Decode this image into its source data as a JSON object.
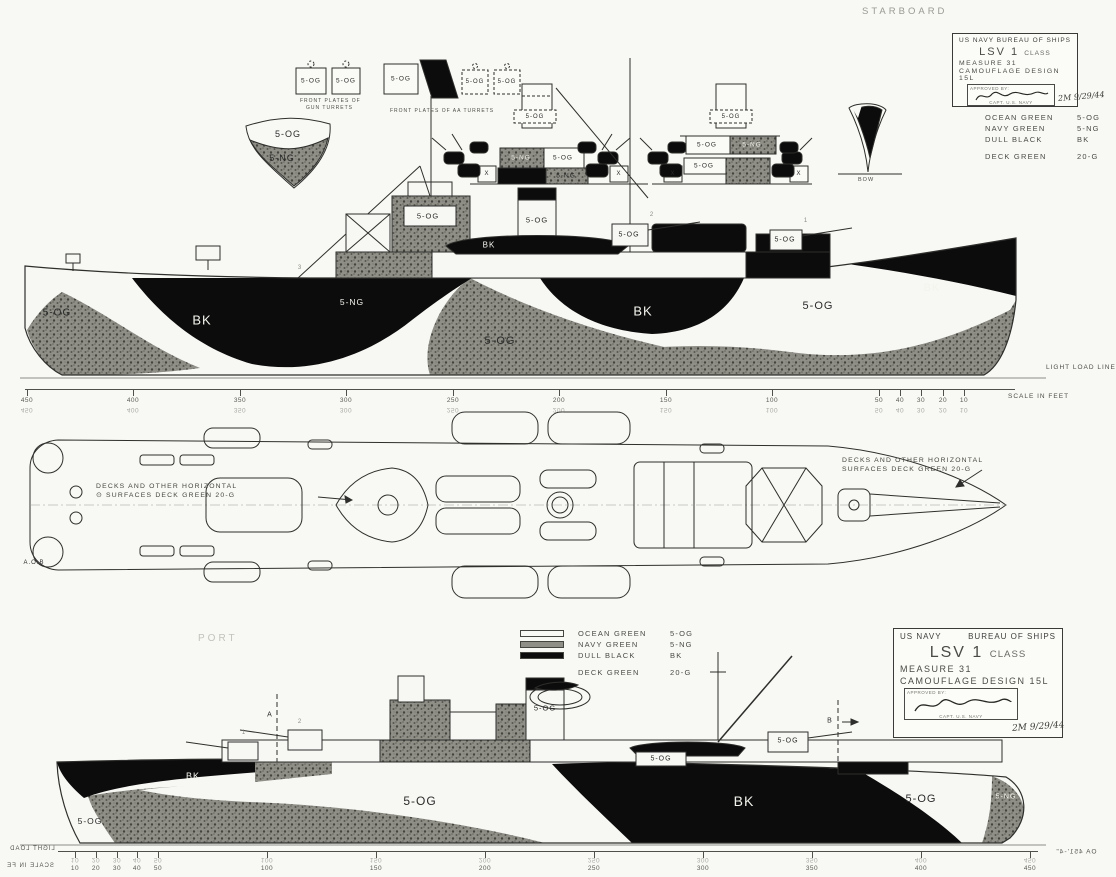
{
  "page": {
    "starboard_label": "STARBOARD",
    "port_label": "PORT",
    "light_load_line": "LIGHT LOAD LINE",
    "aob_label": "A.O.B"
  },
  "title_block": {
    "agency": "US NAVY",
    "bureau": "BUREAU OF SHIPS",
    "ship_class": "LSV 1",
    "class_suffix": "CLASS",
    "measure": "MEASURE 31",
    "design": "CAMOUFLAGE DESIGN 15L",
    "approved_label": "APPROVED BY:",
    "signer_title": "CAPT. U.S. NAVY",
    "date_note": "2M 9/29/44"
  },
  "legend": {
    "rows": [
      {
        "name": "OCEAN GREEN",
        "code": "5-OG"
      },
      {
        "name": "NAVY GREEN",
        "code": "5-NG"
      },
      {
        "name": "DULL BLACK",
        "code": "BK"
      },
      {
        "name": "DECK GREEN",
        "code": "20-G"
      }
    ]
  },
  "deck_note": {
    "symbol": "⊙",
    "line1": "DECKS AND OTHER HORIZONTAL",
    "line2": "SURFACES   DECK GREEN   20-G"
  },
  "details": {
    "gun_caption_1": "FRONT PLATES OF",
    "gun_caption_2": "GUN TURRETS",
    "aa_caption": "FRONT PLATES OF AA TURRETS",
    "bow_caption": "BOW"
  },
  "scales": {
    "label": "SCALE IN FEET",
    "top": {
      "ticks": [
        {
          "v": "450",
          "x": 2
        },
        {
          "v": "400",
          "x": 108
        },
        {
          "v": "350",
          "x": 215
        },
        {
          "v": "300",
          "x": 321
        },
        {
          "v": "250",
          "x": 428
        },
        {
          "v": "200",
          "x": 534
        },
        {
          "v": "150",
          "x": 641
        },
        {
          "v": "100",
          "x": 747
        },
        {
          "v": "50",
          "x": 854
        },
        {
          "v": "40",
          "x": 875
        },
        {
          "v": "30",
          "x": 896
        },
        {
          "v": "20",
          "x": 918
        },
        {
          "v": "10",
          "x": 939
        }
      ]
    },
    "bottom": {
      "ticks": [
        {
          "v": "10",
          "x": 17
        },
        {
          "v": "20",
          "x": 38
        },
        {
          "v": "30",
          "x": 59
        },
        {
          "v": "40",
          "x": 79
        },
        {
          "v": "50",
          "x": 100
        },
        {
          "v": "100",
          "x": 209
        },
        {
          "v": "150",
          "x": 318
        },
        {
          "v": "200",
          "x": 427
        },
        {
          "v": "250",
          "x": 536
        },
        {
          "v": "300",
          "x": 645
        },
        {
          "v": "350",
          "x": 754
        },
        {
          "v": "400",
          "x": 863
        },
        {
          "v": "450",
          "x": 972
        }
      ]
    }
  },
  "labels": {
    "detail_strip": [
      {
        "t": "5-OG",
        "x": 288,
        "y": 134,
        "s": 9
      },
      {
        "t": "5-NG",
        "x": 282,
        "y": 158,
        "s": 9
      },
      {
        "t": "5-OG",
        "x": 311,
        "y": 81,
        "s": 6.5
      },
      {
        "t": "5-OG",
        "x": 346,
        "y": 81,
        "s": 6.5
      },
      {
        "t": "5-OG",
        "x": 401,
        "y": 79,
        "s": 6.5
      },
      {
        "t": "5-OG",
        "x": 475,
        "y": 82,
        "s": 6
      },
      {
        "t": "5-OG",
        "x": 507,
        "y": 82,
        "s": 6
      },
      {
        "t": "5-OG",
        "x": 535,
        "y": 117,
        "s": 6
      },
      {
        "t": "5-NG",
        "x": 521,
        "y": 158,
        "s": 6.5,
        "c": "white"
      },
      {
        "t": "5-OG",
        "x": 563,
        "y": 158,
        "s": 6.5
      },
      {
        "t": "5-NG",
        "x": 566,
        "y": 176,
        "s": 6.5
      },
      {
        "t": "5-OG",
        "x": 731,
        "y": 117,
        "s": 6
      },
      {
        "t": "5-OG",
        "x": 707,
        "y": 145,
        "s": 6.5
      },
      {
        "t": "5-NG",
        "x": 752,
        "y": 145,
        "s": 6.5,
        "c": "white"
      },
      {
        "t": "5-OG",
        "x": 704,
        "y": 166,
        "s": 6.5
      },
      {
        "t": "X",
        "x": 487,
        "y": 174,
        "s": 6
      },
      {
        "t": "X",
        "x": 619,
        "y": 174,
        "s": 6
      },
      {
        "t": "X",
        "x": 673,
        "y": 174,
        "s": 6
      },
      {
        "t": "X",
        "x": 799,
        "y": 174,
        "s": 6
      }
    ],
    "starboard": [
      {
        "t": "5-OG",
        "x": 57,
        "y": 313,
        "s": 10
      },
      {
        "t": "BK",
        "x": 202,
        "y": 320,
        "s": 13,
        "c": "white"
      },
      {
        "t": "5-OG",
        "x": 500,
        "y": 341,
        "s": 11
      },
      {
        "t": "BK",
        "x": 643,
        "y": 311,
        "s": 13,
        "c": "white"
      },
      {
        "t": "5-OG",
        "x": 818,
        "y": 306,
        "s": 11
      },
      {
        "t": "BK",
        "x": 932,
        "y": 288,
        "s": 11,
        "c": "white"
      },
      {
        "t": "5-NG",
        "x": 794,
        "y": 357,
        "s": 8.5,
        "c": "faint"
      },
      {
        "t": "5-NG",
        "x": 352,
        "y": 302,
        "s": 8.5,
        "c": "white"
      },
      {
        "t": "5-OG",
        "x": 428,
        "y": 216,
        "s": 7.5
      },
      {
        "t": "5-OG",
        "x": 537,
        "y": 220,
        "s": 7.5
      },
      {
        "t": "BK",
        "x": 489,
        "y": 245,
        "s": 8,
        "c": "white"
      },
      {
        "t": "5-OG",
        "x": 629,
        "y": 235,
        "s": 7
      },
      {
        "t": "5-OG",
        "x": 785,
        "y": 240,
        "s": 7
      },
      {
        "t": "2",
        "x": 652,
        "y": 215,
        "s": 6,
        "c": "faint"
      },
      {
        "t": "1",
        "x": 806,
        "y": 221,
        "s": 6,
        "c": "faint"
      },
      {
        "t": "3",
        "x": 300,
        "y": 268,
        "s": 6,
        "c": "faint"
      }
    ],
    "plan": [
      {
        "t": "A.O.B",
        "x": 34,
        "y": 563,
        "s": 6
      }
    ],
    "port": [
      {
        "t": "5-OG",
        "x": 90,
        "y": 821,
        "s": 8.5
      },
      {
        "t": "BK",
        "x": 193,
        "y": 776,
        "s": 9,
        "c": "white"
      },
      {
        "t": "5-OG",
        "x": 420,
        "y": 801,
        "s": 12
      },
      {
        "t": "BK",
        "x": 744,
        "y": 801,
        "s": 14,
        "c": "white"
      },
      {
        "t": "5-OG",
        "x": 921,
        "y": 799,
        "s": 11
      },
      {
        "t": "5-NG",
        "x": 1006,
        "y": 797,
        "s": 7,
        "c": "white"
      },
      {
        "t": "5-OG",
        "x": 545,
        "y": 708,
        "s": 7.5
      },
      {
        "t": "5-OG",
        "x": 661,
        "y": 759,
        "s": 7
      },
      {
        "t": "5-OG",
        "x": 788,
        "y": 741,
        "s": 7
      },
      {
        "t": "A",
        "x": 270,
        "y": 715,
        "s": 7
      },
      {
        "t": "B",
        "x": 830,
        "y": 721,
        "s": 7
      },
      {
        "t": "1",
        "x": 244,
        "y": 733,
        "s": 6,
        "c": "faint"
      },
      {
        "t": "2",
        "x": 300,
        "y": 722,
        "s": 6,
        "c": "faint"
      }
    ],
    "mirrored": [
      {
        "t": "LIGHT LOAD",
        "x": 32,
        "y": 849,
        "s": 6,
        "m": true
      },
      {
        "t": "SCALE IN FE",
        "x": 30,
        "y": 866,
        "s": 6,
        "m": true
      },
      {
        "t": "OA 451'-4\"",
        "x": 1076,
        "y": 852,
        "s": 6.5,
        "m": true
      }
    ]
  }
}
